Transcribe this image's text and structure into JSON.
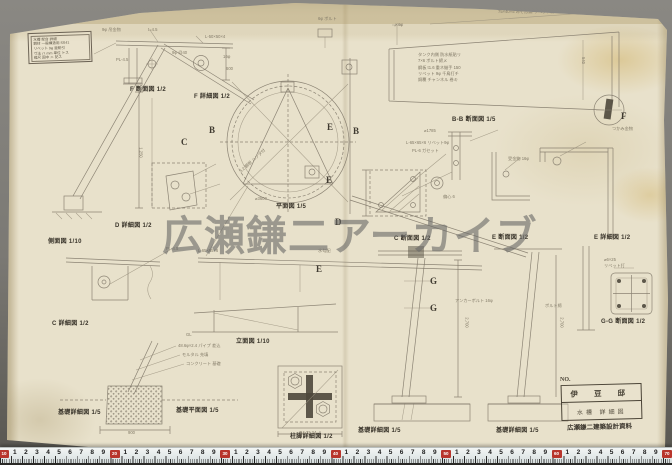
{
  "photo": {
    "watermark": "広瀬鎌二アーカイブ",
    "background_color": "#7b7974",
    "paper_color": "#e8e1cb",
    "pencil_color": "#7b7365",
    "ruler_red": "#b8352c"
  },
  "title_block": {
    "lines": [
      "水槽 架台 詳細",
      "鋼材 一般構造用 SS41",
      "リベット 9φ 亜鉛引",
      "寸法 ハ mm 単位 トス",
      "縮尺 図中 ニ 記ス",
      "昭和 30・5"
    ]
  },
  "info_block": {
    "no_label": "NO.",
    "line1": "伊 豆 邸",
    "line2": "水槽 詳細図",
    "stamp": "広瀬鎌二建築設計資料"
  },
  "labels": [
    {
      "x": 130,
      "y": 84,
      "t": "F 断面図 1/2"
    },
    {
      "x": 194,
      "y": 91,
      "t": "F 詳細図 1/2"
    },
    {
      "x": 452,
      "y": 114,
      "t": "B-B 断面図 1/5"
    },
    {
      "x": 276,
      "y": 201,
      "t": "平面図 1/5"
    },
    {
      "x": 48,
      "y": 236,
      "t": "側面図 1/10"
    },
    {
      "x": 115,
      "y": 220,
      "t": "D 詳細図 1/2"
    },
    {
      "x": 52,
      "y": 318,
      "t": "C 詳細図 1/2"
    },
    {
      "x": 394,
      "y": 233,
      "t": "C 断面図 1/2"
    },
    {
      "x": 492,
      "y": 232,
      "t": "E 断面図 1/2"
    },
    {
      "x": 594,
      "y": 232,
      "t": "E 詳細図 1/2"
    },
    {
      "x": 236,
      "y": 336,
      "t": "立面図 1/10"
    },
    {
      "x": 601,
      "y": 316,
      "t": "G-G 断面図 1/2"
    },
    {
      "x": 58,
      "y": 407,
      "t": "基礎詳細図 1/5"
    },
    {
      "x": 176,
      "y": 405,
      "t": "基礎平面図 1/5"
    },
    {
      "x": 290,
      "y": 431,
      "t": "柱脚詳細図 1/2"
    },
    {
      "x": 358,
      "y": 425,
      "t": "基礎詳細図 1/5"
    },
    {
      "x": 496,
      "y": 425,
      "t": "基礎詳細図 1/5"
    }
  ],
  "letters": [
    {
      "x": 181,
      "y": 137,
      "t": "C"
    },
    {
      "x": 209,
      "y": 125,
      "t": "B"
    },
    {
      "x": 327,
      "y": 122,
      "t": "E"
    },
    {
      "x": 326,
      "y": 175,
      "t": "E"
    },
    {
      "x": 353,
      "y": 126,
      "t": "B"
    },
    {
      "x": 335,
      "y": 217,
      "t": "D"
    },
    {
      "x": 316,
      "y": 264,
      "t": "E"
    },
    {
      "x": 621,
      "y": 111,
      "t": "F"
    },
    {
      "x": 430,
      "y": 276,
      "t": "G"
    },
    {
      "x": 430,
      "y": 303,
      "t": "G"
    }
  ],
  "annotations": [
    {
      "x": 102,
      "y": 27,
      "t": "9φ 吊金物"
    },
    {
      "x": 148,
      "y": 27,
      "t": "t=4.5"
    },
    {
      "x": 205,
      "y": 34,
      "t": "L-50×50×4"
    },
    {
      "x": 172,
      "y": 50,
      "t": "9φ @40"
    },
    {
      "x": 116,
      "y": 57,
      "t": "PL-4.5"
    },
    {
      "x": 223,
      "y": 54,
      "t": "16φ"
    },
    {
      "x": 318,
      "y": 16,
      "t": "6φ ボルト"
    },
    {
      "x": 394,
      "y": 22,
      "t": "〆6φ"
    },
    {
      "x": 498,
      "y": 9,
      "t": "75×40×5 みぞ形鋼 リベット打"
    },
    {
      "x": 236,
      "y": 158,
      "t": "3.2 鋼板 ハンダ付",
      "r": -42
    },
    {
      "x": 406,
      "y": 140,
      "t": "L-65×65×6 リベット9φ"
    },
    {
      "x": 412,
      "y": 148,
      "t": "PL-6 ガセット"
    },
    {
      "x": 424,
      "y": 128,
      "t": "⌀1785"
    },
    {
      "x": 443,
      "y": 194,
      "t": "偏心 6"
    },
    {
      "x": 508,
      "y": 156,
      "t": "受金物 16φ"
    },
    {
      "x": 612,
      "y": 126,
      "t": "つかみ金物"
    },
    {
      "x": 604,
      "y": 257,
      "t": "⌀6×25"
    },
    {
      "x": 604,
      "y": 263,
      "t": "リベット打"
    },
    {
      "x": 318,
      "y": 248,
      "t": "水勾配"
    },
    {
      "x": 198,
      "y": 248,
      "t": "L-65×65×6"
    },
    {
      "x": 166,
      "y": 246,
      "t": "PL-4.5"
    },
    {
      "x": 178,
      "y": 343,
      "t": "48.6φ×2.4 パイプ 差込"
    },
    {
      "x": 182,
      "y": 352,
      "t": "モルタル 充填"
    },
    {
      "x": 186,
      "y": 361,
      "t": "コンクリート 基礎"
    },
    {
      "x": 186,
      "y": 332,
      "t": "GL"
    },
    {
      "x": 128,
      "y": 430,
      "t": "900"
    },
    {
      "x": 300,
      "y": 430,
      "t": "24 72 24"
    },
    {
      "x": 455,
      "y": 298,
      "t": "アンカーボルト 16φ"
    },
    {
      "x": 545,
      "y": 303,
      "t": "ボルト締"
    },
    {
      "x": 136,
      "y": 150,
      "t": "1,250",
      "r": 90
    },
    {
      "x": 462,
      "y": 320,
      "t": "2,700",
      "r": 90
    },
    {
      "x": 557,
      "y": 320,
      "t": "2,700",
      "r": 90
    },
    {
      "x": 226,
      "y": 66,
      "t": "600"
    },
    {
      "x": 580,
      "y": 58,
      "t": "540",
      "r": 90
    },
    {
      "x": 255,
      "y": 196,
      "t": "⌀3600"
    }
  ],
  "trap_notes": {
    "x": 418,
    "y": 52,
    "lines": [
      "タンク内側 防水紙貼リ",
      "7×6 ボルト締メ",
      "鋼板 t1.6 重ネ継手 150",
      "リベット 9φ 千鳥打チ",
      "銅覆 チャンネル 巻キ"
    ]
  },
  "ruler": {
    "start_x": 4,
    "cm_px": 11.05,
    "decade_values": [
      "10",
      "20",
      "30",
      "40",
      "50",
      "60",
      "70"
    ],
    "digits": [
      "1",
      "2",
      "3",
      "4",
      "5",
      "6",
      "7",
      "8",
      "9"
    ]
  }
}
